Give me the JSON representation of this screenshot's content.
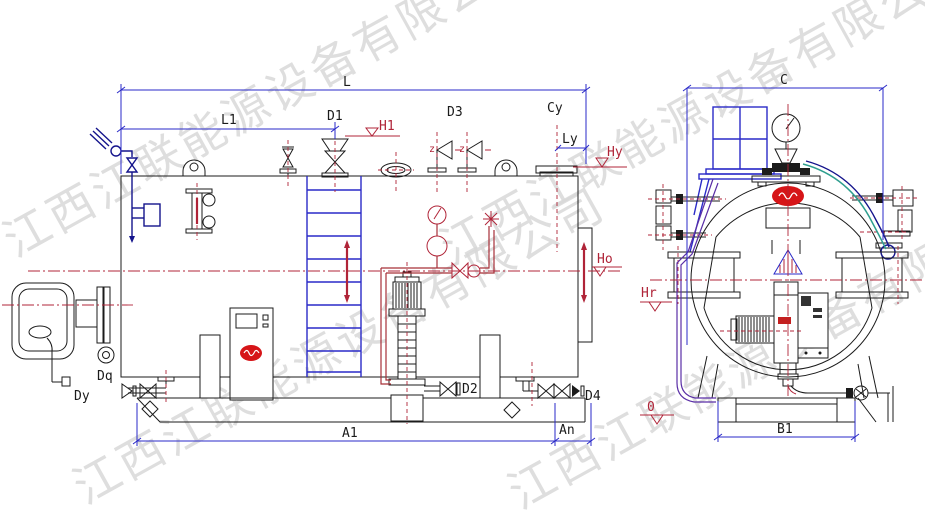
{
  "watermark": {
    "text": "江西江联能源设备有限公司",
    "color": "#d9d9d9"
  },
  "labels": {
    "L": "L",
    "L1": "L1",
    "A1": "A1",
    "An": "An",
    "C": "C",
    "B1": "B1",
    "Ly": "Ly",
    "Cy": "Cy",
    "D1": "D1",
    "D2": "D2",
    "D3": "D3",
    "D4": "D4",
    "Dq": "Dq",
    "Dy": "Dy",
    "H1": "H1",
    "Hy": "Hy",
    "Ho": "Ho",
    "Hr": "Hr",
    "z": "z",
    "datum": "0"
  },
  "colors": {
    "line": "#1b1b1b",
    "dimension": "#2a2ac8",
    "centerline": "#b02438",
    "pipe_red": "#a63038",
    "pipe_navy": "#14148c",
    "pipe_teal": "#2f9e8f",
    "pipe_purple": "#5a2ea6",
    "logo_red": "#d61518",
    "watermark": "#d9d9d9",
    "background": "#ffffff"
  }
}
